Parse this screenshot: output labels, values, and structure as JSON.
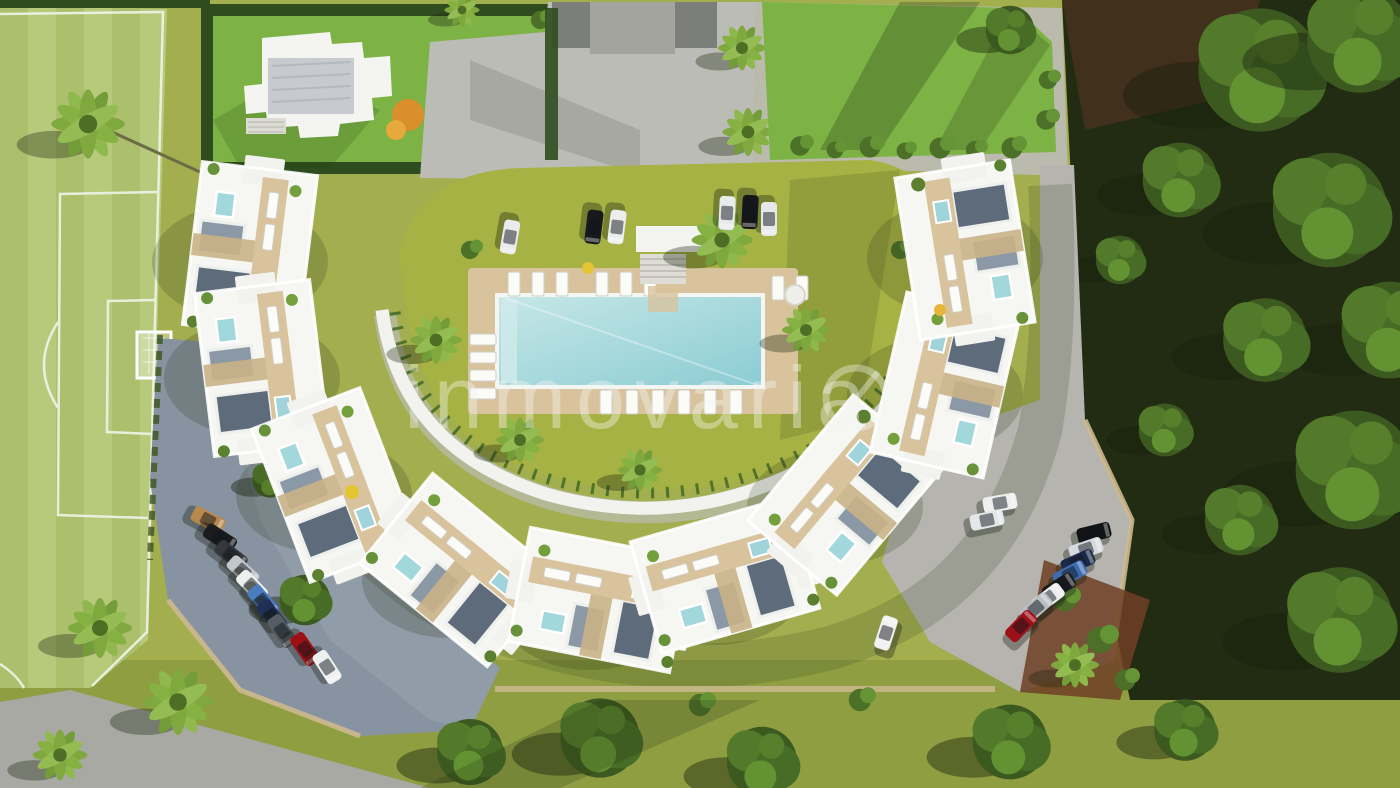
{
  "watermark": {
    "text": "inmovaria",
    "color": "#f4f6f2",
    "opacity": 0.4
  },
  "palette": {
    "grass_olive": "#a3ae4f",
    "grass_bottom": "#87983c",
    "field_green": "#b7ca7c",
    "field_stripe": "#abbf6d",
    "line_white": "#f0f4e8",
    "lawn_bright": "#7cb344",
    "courtyard_lawn": "#a6b243",
    "hedge_dark": "#2e4c1d",
    "woodland_floor": "#222c12",
    "woodland_soil": "#45311e",
    "pavement": "#bcbcb6",
    "pavement_shade": "#a8a9a3",
    "road_dark": "#74777400",
    "asphalt": "#8793a0",
    "building_white": "#f6f7f3",
    "deck_tan": "#d8c39c",
    "pool_blue": "#a9d9dd",
    "roof_panel_dark": "#5e6b7a",
    "roof_panel_light": "#8b98a6",
    "mulch": "#6e3f24",
    "wall_tan": "#cdb98f"
  },
  "cars": {
    "top_row": [
      {
        "c": "#e9ebec",
        "x": 510,
        "y": 237,
        "r": 100
      },
      {
        "c": "#17191c",
        "x": 594,
        "y": 227,
        "r": 97
      },
      {
        "c": "#eceded",
        "x": 617,
        "y": 227,
        "r": 97
      },
      {
        "c": "#e8eaeb",
        "x": 727,
        "y": 213,
        "r": 93
      },
      {
        "c": "#141619",
        "x": 750,
        "y": 212,
        "r": 93
      },
      {
        "c": "#e6e8ea",
        "x": 769,
        "y": 219,
        "r": 90
      }
    ],
    "bottom_left": [
      {
        "c": "#b8894c",
        "x": 208,
        "y": 520,
        "r": 28
      },
      {
        "c": "#1a1c1f",
        "x": 220,
        "y": 538,
        "r": 33
      },
      {
        "c": "#34383d",
        "x": 231,
        "y": 555,
        "r": 38
      },
      {
        "c": "#c2c7cb",
        "x": 243,
        "y": 571,
        "r": 42
      },
      {
        "c": "#eef0f0",
        "x": 252,
        "y": 586,
        "r": 46
      },
      {
        "c": "#4a7dc0",
        "x": 263,
        "y": 601,
        "r": 49
      },
      {
        "c": "#1f2f55",
        "x": 272,
        "y": 616,
        "r": 52
      },
      {
        "c": "#555c64",
        "x": 282,
        "y": 631,
        "r": 55
      },
      {
        "c": "#9e1016",
        "x": 305,
        "y": 649,
        "r": 55
      },
      {
        "c": "#eff0ef",
        "x": 327,
        "y": 667,
        "r": 57
      }
    ],
    "bottom_right": [
      {
        "c": "#eef0f0",
        "x": 1000,
        "y": 503,
        "r": -10
      },
      {
        "c": "#111316",
        "x": 1094,
        "y": 533,
        "r": -14
      },
      {
        "c": "#d7dade",
        "x": 1086,
        "y": 549,
        "r": -19
      },
      {
        "c": "#1c2a4a",
        "x": 1078,
        "y": 562,
        "r": -24
      },
      {
        "c": "#3e6cb0",
        "x": 1070,
        "y": 574,
        "r": -28
      },
      {
        "c": "#17191c",
        "x": 1059,
        "y": 587,
        "r": -33
      },
      {
        "c": "#eceeee",
        "x": 1048,
        "y": 598,
        "r": -37
      },
      {
        "c": "#b9bec3",
        "x": 1036,
        "y": 608,
        "r": -41
      },
      {
        "c": "#9c1118",
        "x": 1021,
        "y": 626,
        "r": -46
      }
    ],
    "other": [
      {
        "c": "#f0f1f0",
        "x": 886,
        "y": 633,
        "r": -72
      },
      {
        "c": "#e4e7e8",
        "x": 987,
        "y": 520,
        "r": -12
      }
    ]
  }
}
